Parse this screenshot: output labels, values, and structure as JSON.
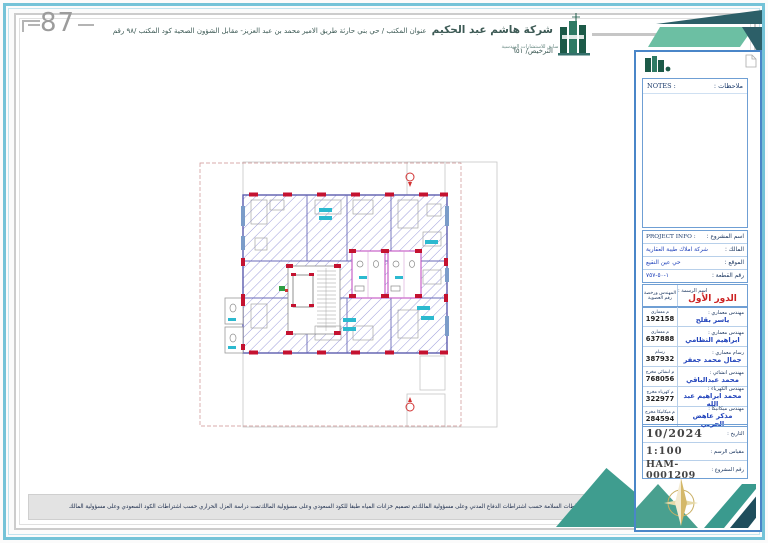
{
  "page": {
    "sheet_number": "87"
  },
  "header": {
    "company_name": "شركة هاشم عبد الحكيم",
    "company_subtitle": "سابق للاستشارات الهندسية",
    "address_line": "عنوان المكتب / حي بني حارثة طريق الامير محمد بن عبد العزيز- مقابل الشؤون الصحية   كود المكتب /٩٨   رقم الترخيص/ ٦٥١"
  },
  "notes": {
    "label_en": "NOTES :",
    "label_ar": "ملاحظات :"
  },
  "project": {
    "title_label_ar": "اسم المشروع :",
    "title_label_en": "PROJECT INFO :",
    "owner_label": "المالك :",
    "owner_value": "شركة املاك طيبة العقارية",
    "site_label": "الموقع :",
    "site_value": "حي عين النقيع",
    "parcel_label": "رقم القطعة :",
    "parcel_value": "١-٥٠-٧٥٧"
  },
  "drawing": {
    "license_header_line1": "المهندس ورخصة",
    "license_header_line2": "رقم العضوية",
    "name_label": "اسم الرسمة :",
    "name_value": "الدور الأول"
  },
  "team": [
    {
      "role": "مهندس معماري :",
      "name": "ياسر بقلح",
      "license_label": "م معماري",
      "license_no": "192158"
    },
    {
      "role": "مهندس معماري :",
      "name": "ابراهيم النظامي",
      "license_label": "م معماري",
      "license_no": "637888"
    },
    {
      "role": "رسام معماري :",
      "name": "جمال محمد جعفر",
      "license_label": "رسام",
      "license_no": "387932"
    },
    {
      "role": "مهندس انشائي :",
      "name": "محمد عبدالباقي",
      "license_label": "م انشائي مخرج",
      "license_no": "768056"
    },
    {
      "role": "مهندس الكهرباء :",
      "name": "محمد ابراهيم عبد الله",
      "license_label": "م كهرباء مخرج",
      "license_no": "322977"
    },
    {
      "role": "مهندس ميكانيكا :",
      "name": "مذكر عاهض الحربي",
      "license_label": "م ميكانيكا مخرج",
      "license_no": "284594"
    }
  ],
  "meta": {
    "date_label": "التاريخ :",
    "date_value": "10/2024",
    "scale_label": "مقياس الرسم :",
    "scale_value": "1:100",
    "project_no_label": "رقم المشروع :",
    "project_no_value": "HAM-0001209"
  },
  "footer": {
    "disclaimers": [
      "تمت دراسة العزل الحراري حسب اشتراطات الكود السعودي وعلى مسؤولية المالك",
      "تم تصميم خزانات المياه طبقا للكود السعودي وعلى مسؤولية المالك",
      "تم عمل مخططات السلامة حسب اشتراطات الدفاع المدني وعلى مسؤولية المالك"
    ]
  },
  "colors": {
    "frame_blue": "#74c3d8",
    "teal_light": "#6cbfa3",
    "teal_mid": "#3f9d8f",
    "teal_dark": "#1e4d5c",
    "logo_green": "#1c5a48",
    "column_red": "#c41230",
    "hatch_blue": "#9191d6",
    "bath_magenta": "#c253c2",
    "label_cyan": "#2cb9cf",
    "text_navy": "#16325c",
    "value_blue": "#2244bb",
    "title_red": "#cc2222",
    "compass_gold": "#d4b86a"
  }
}
